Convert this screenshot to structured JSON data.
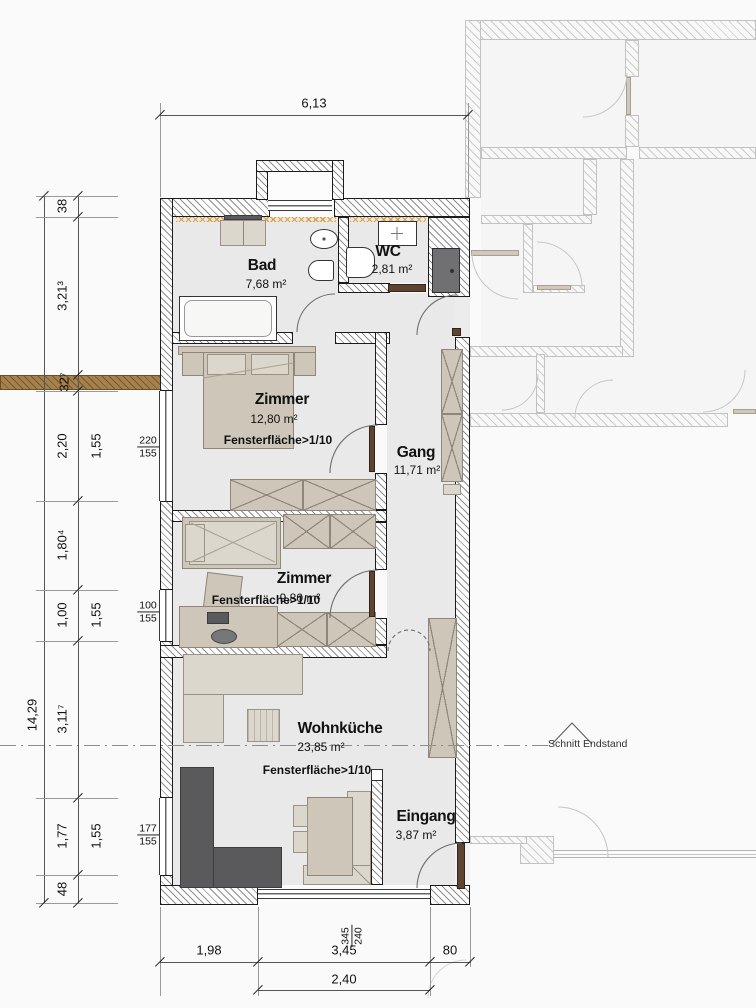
{
  "plan": {
    "rooms": {
      "bad": {
        "name": "Bad",
        "area": "7,68 m²"
      },
      "wc": {
        "name": "WC",
        "area": "2,81 m²"
      },
      "zimmer1": {
        "name": "Zimmer",
        "area": "12,80 m²",
        "note": "Fensterfläche>1/10"
      },
      "gang": {
        "name": "Gang",
        "area": "11,71 m²"
      },
      "zimmer2": {
        "name": "Zimmer",
        "area": "9,80 m²",
        "note": "Fensterfläche>1/10"
      },
      "wohnkueche": {
        "name": "Wohnküche",
        "area": "23,85 m²",
        "note": "Fensterfläche>1/10"
      },
      "eingang": {
        "name": "Eingang",
        "area": "3,87 m²"
      }
    },
    "section_label": "Schnitt Endstand"
  },
  "dimensions": {
    "top_width": "6,13",
    "left_total": "14,29",
    "left_chain": {
      "c38": "38",
      "c321": "3,21³",
      "c32": "32⁷",
      "c220": "2,20",
      "c180": "1,80⁴",
      "c100": "1,00",
      "c311": "3,11⁷",
      "c177": "1,77",
      "c48": "48"
    },
    "sills": {
      "s1": "1,55",
      "s2": "1,55",
      "s3": "1,55"
    },
    "bottom": {
      "b198": "1,98",
      "b345": "3,45",
      "b80": "80",
      "b240": "2,40"
    },
    "windows": {
      "w1": {
        "w": "220",
        "h": "155"
      },
      "w2": {
        "w": "100",
        "h": "155"
      },
      "w3": {
        "w": "177",
        "h": "155"
      },
      "w4": {
        "w": "345",
        "h": "240"
      }
    }
  },
  "colors": {
    "wall_outline": "#1b1b1b",
    "floor_gray": "#e9e9e9",
    "furniture_beige": "#cec7b9",
    "kitchen_dark": "#5a5a5c",
    "door_brown": "#5e4431",
    "insulation_orange": "#dd9e3e",
    "masonry_brown": "#a5814e"
  }
}
